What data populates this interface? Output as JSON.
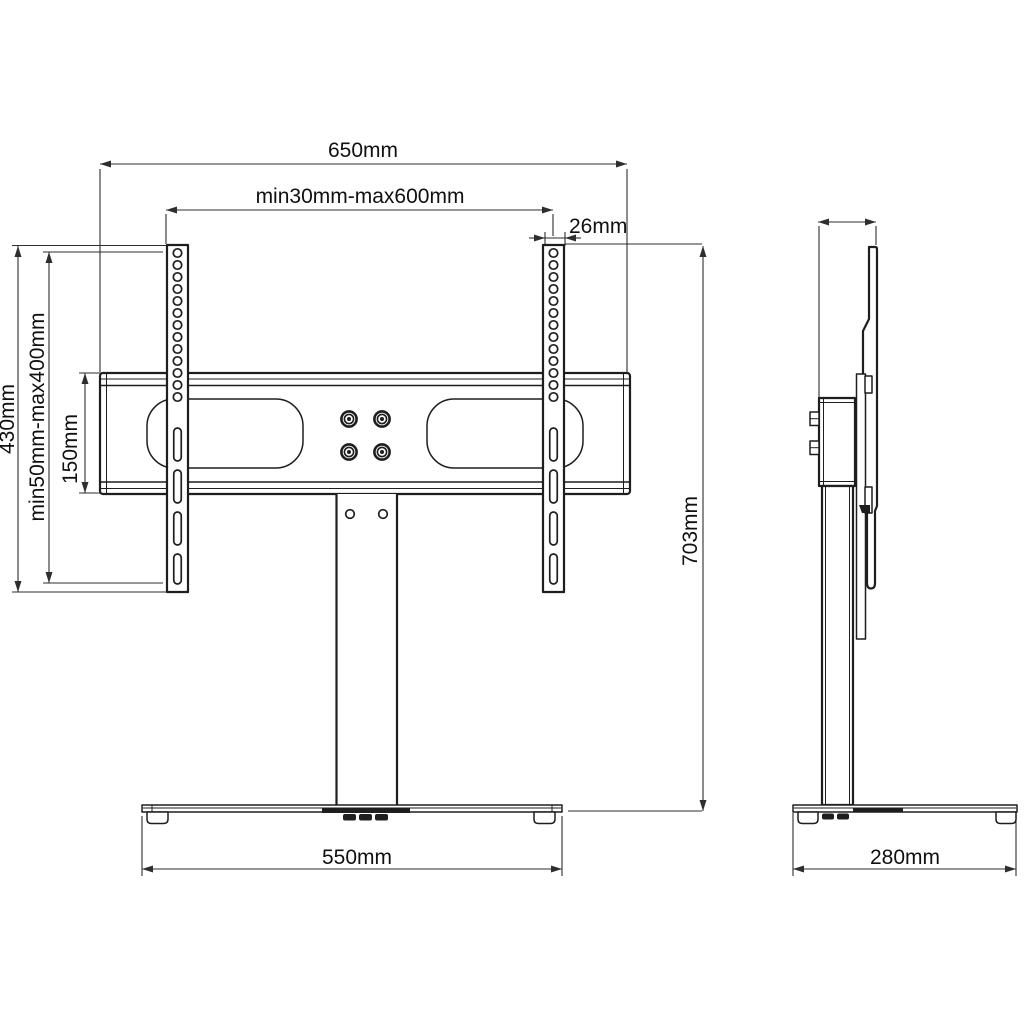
{
  "drawing": {
    "type": "technical-drawing",
    "subject": "tv-stand-bracket",
    "views": {
      "front": {
        "dims": {
          "overall_width": "650mm",
          "rail_spacing": "min30mm-max600mm",
          "rail_width": "26mm",
          "rail_height": "430mm",
          "vesa_vertical_range": "min50mm-max400mm",
          "bracket_height": "150mm",
          "base_width": "550mm"
        }
      },
      "side": {
        "dims": {
          "overall_height": "703mm",
          "base_depth": "280mm"
        }
      }
    },
    "colors": {
      "line": "#1e1e1e",
      "dimension": "#2e2e2e",
      "text": "#101010",
      "background": "#ffffff"
    }
  }
}
